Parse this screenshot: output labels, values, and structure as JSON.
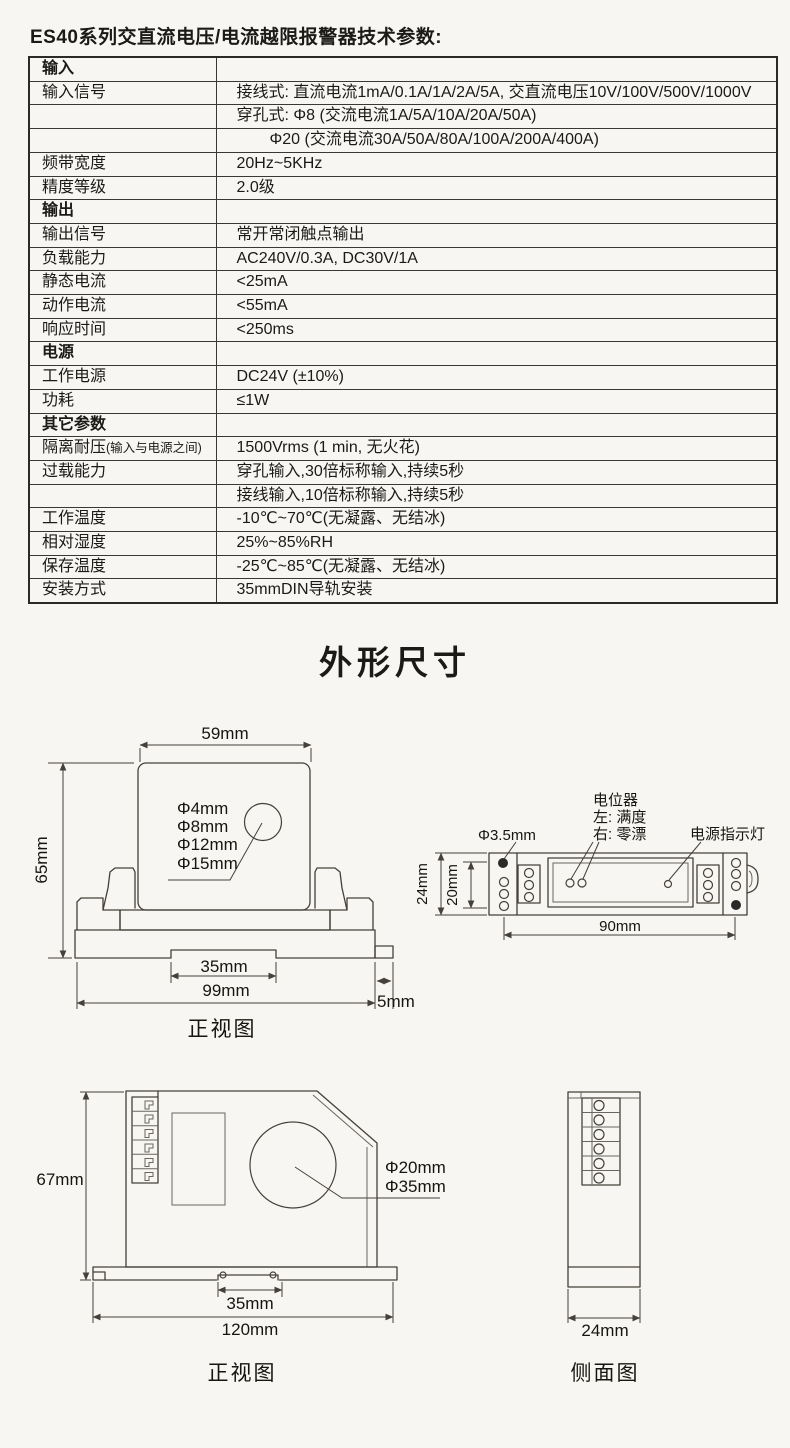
{
  "page": {
    "title": "ES40系列交直流电压/电流越限报警器技术参数:",
    "section_heading": "外形尺寸"
  },
  "table": {
    "rows": [
      {
        "label": "输入",
        "value": ""
      },
      {
        "label": "输入信号",
        "value": "接线式: 直流电流1mA/0.1A/1A/2A/5A, 交直流电压10V/100V/500V/1000V"
      },
      {
        "label": "",
        "value": "穿孔式: Φ8 (交流电流1A/5A/10A/20A/50A)"
      },
      {
        "label": "",
        "value": "Φ20 (交流电流30A/50A/80A/100A/200A/400A)"
      },
      {
        "label": "频带宽度",
        "value": "20Hz~5KHz"
      },
      {
        "label": "精度等级",
        "value": "2.0级"
      },
      {
        "label": "输出",
        "value": ""
      },
      {
        "label": "输出信号",
        "value": "常开常闭触点输出"
      },
      {
        "label": "负载能力",
        "value": "AC240V/0.3A, DC30V/1A"
      },
      {
        "label": "静态电流",
        "value": "<25mA"
      },
      {
        "label": "动作电流",
        "value": "<55mA"
      },
      {
        "label": "响应时间",
        "value": "<250ms"
      },
      {
        "label": "电源",
        "value": ""
      },
      {
        "label": "工作电源",
        "value": "DC24V (±10%)"
      },
      {
        "label": "功耗",
        "value": "≤1W"
      },
      {
        "label": "其它参数",
        "value": ""
      },
      {
        "label": "隔离耐压",
        "label_small": "(输入与电源之间)",
        "value": "1500Vrms (1 min, 无火花)"
      },
      {
        "label": "过载能力",
        "value": "穿孔输入,30倍标称输入,持续5秒"
      },
      {
        "label": "",
        "value": "接线输入,10倍标称输入,持续5秒"
      },
      {
        "label": "工作温度",
        "value": "-10℃~70℃(无凝露、无结冰)"
      },
      {
        "label": "相对湿度",
        "value": "25%~85%RH"
      },
      {
        "label": "保存温度",
        "value": "-25℃~85℃(无凝露、无结冰)"
      },
      {
        "label": "安装方式",
        "value": "35mmDIN导轨安装"
      }
    ]
  },
  "drawings": {
    "front_view_small": {
      "caption": "正视图",
      "hole_labels": [
        "Φ4mm",
        "Φ8mm",
        "Φ12mm",
        "Φ15mm"
      ],
      "dims": {
        "width_top": "59mm",
        "height_left": "65mm",
        "rail_notch": "35mm",
        "width_bottom": "99mm",
        "tab": "5mm"
      }
    },
    "top_view": {
      "labels": {
        "pot": "电位器",
        "pot_left": "左: 满度",
        "pot_right": "右: 零漂",
        "power_led": "电源指示灯",
        "hole": "Φ3.5mm"
      },
      "dims": {
        "height": "24mm",
        "inner_height": "20mm",
        "hole_span": "90mm"
      }
    },
    "front_view_large": {
      "caption": "正视图",
      "hole_labels": [
        "Φ20mm",
        "Φ35mm"
      ],
      "dims": {
        "height": "67mm",
        "rail_notch": "35mm",
        "width": "120mm"
      }
    },
    "side_view": {
      "caption": "侧面图",
      "dims": {
        "width": "24mm"
      }
    }
  }
}
